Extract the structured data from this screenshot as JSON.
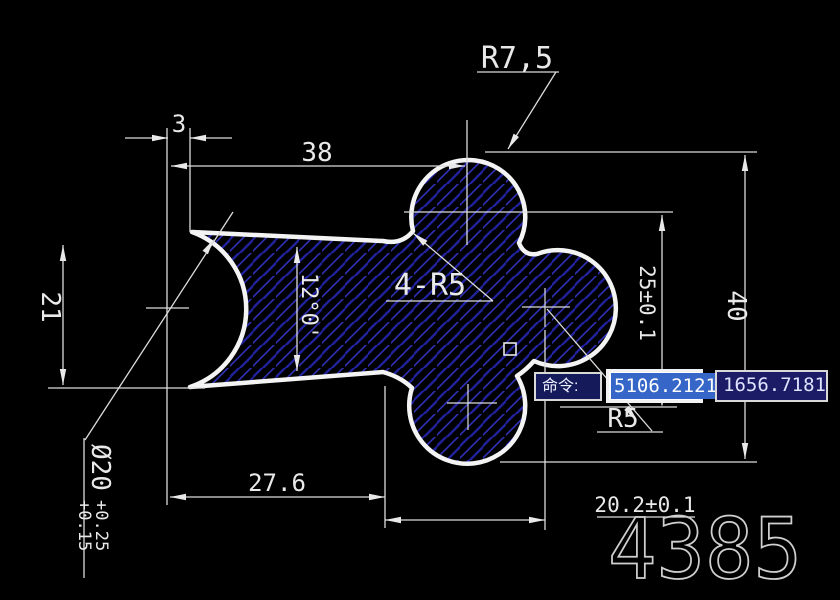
{
  "window": {
    "background": "#000000",
    "part_number": "4385"
  },
  "drawing": {
    "colors": {
      "outline": "#f4f4f4",
      "dim_line": "#dcdcdc",
      "hatch_dark": "#21219c",
      "hatch_light": "#3030b8"
    },
    "labels": {
      "radius_top": "R7,5",
      "dim_3": "3",
      "dim_38": "38",
      "dim_21": "21",
      "angle": "12°0'",
      "fillets": "4-R5",
      "dim_25": "25±0.1",
      "dim_40": "40",
      "radius_small": "R5",
      "dim_276": "27.6",
      "dim_202": "20.2±0.1",
      "dia_main": "Ø20",
      "dia_tol_upper": "+0.25",
      "dia_tol_lower": "+0.15"
    }
  },
  "command_tooltip": {
    "label": "命令:",
    "coord_x": "5106.2121",
    "coord_y": "1656.7181",
    "selection_color": "#3566c8",
    "box_color": "#151a5a"
  }
}
